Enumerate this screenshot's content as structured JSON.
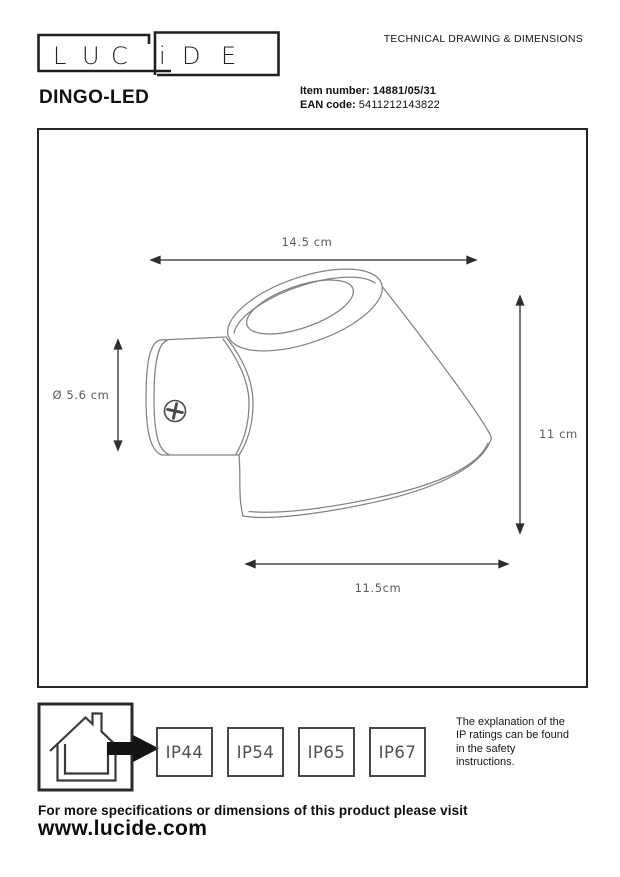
{
  "colors": {
    "ink": "#1c1c1c",
    "drawing_line_gray": "#828282",
    "dimension_line": "#2e2e2e",
    "dimension_label_gray": "#5a5a5a",
    "ip_badge_gray": "#4f4f4f"
  },
  "header": {
    "logo_letters": [
      "L",
      "U",
      "C",
      "i",
      "D",
      "E"
    ],
    "doc_title": "TECHNICAL DRAWING & DIMENSIONS",
    "product_name": "DINGO-LED",
    "item_number_label": "Item number:",
    "item_number_value": "14881/05/31",
    "ean_label": "EAN code:",
    "ean_value": "5411212143822"
  },
  "drawing": {
    "view": "side view of wall-mounted cone spotlight",
    "icons": {
      "screw": "phillips-screw-icon"
    },
    "dim_top_width": "14.5 cm",
    "dim_diameter": "Ø 5.6 cm",
    "dim_height": "11 cm",
    "dim_bottom_width": "11.5cm"
  },
  "ip_section": {
    "house_icon": "house-outdoor-arrow-icon",
    "ratings": [
      "IP44",
      "IP54",
      "IP65",
      "IP67"
    ],
    "note_lines": [
      "The explanation of the",
      "IP ratings can be found",
      "in the safety",
      "instructions."
    ]
  },
  "footer": {
    "visit_text": "For more specifications or dimensions of this product please visit",
    "website": "www.lucide.com"
  }
}
